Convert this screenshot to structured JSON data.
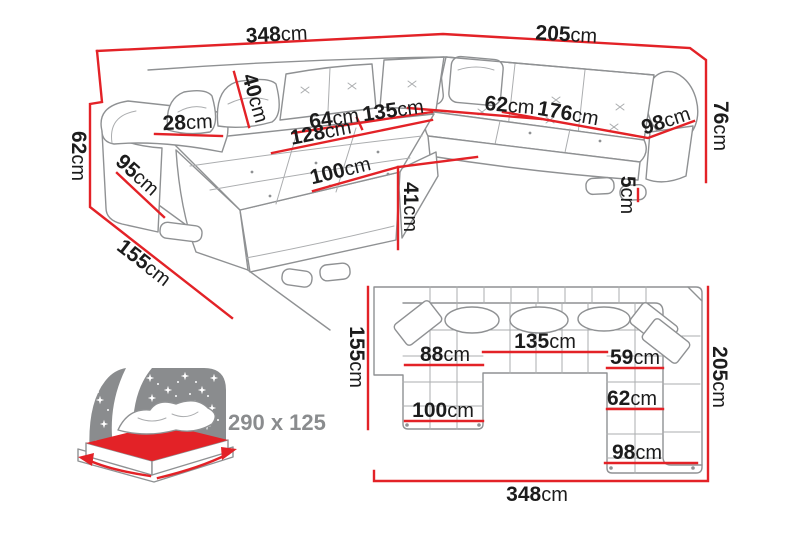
{
  "colors": {
    "red": "#e32227",
    "line_gray": "#8f9193",
    "text_dark": "#1c1c1c",
    "muted_gray": "#8a8c8e"
  },
  "perspective_view": {
    "labels": {
      "total_width": {
        "value": "348",
        "unit": "cm"
      },
      "right_section_width": {
        "value": "205",
        "unit": "cm"
      },
      "backrest_height": {
        "value": "76",
        "unit": "cm"
      },
      "cushion_height": {
        "value": "40",
        "unit": "cm"
      },
      "seat_depth_left": {
        "value": "64",
        "unit": "cm"
      },
      "middle_seat_width": {
        "value": "135",
        "unit": "cm"
      },
      "corner_seat_depth": {
        "value": "62",
        "unit": "cm"
      },
      "right_seat_length": {
        "value": "176",
        "unit": "cm"
      },
      "right_section_depth": {
        "value": "98",
        "unit": "cm"
      },
      "armrest_width": {
        "value": "28",
        "unit": "cm"
      },
      "chaise_length": {
        "value": "128",
        "unit": "cm"
      },
      "armrest_height": {
        "value": "62",
        "unit": "cm"
      },
      "side_depth": {
        "value": "95",
        "unit": "cm"
      },
      "chaise_width": {
        "value": "100",
        "unit": "cm"
      },
      "seat_height": {
        "value": "41",
        "unit": "cm"
      },
      "leg_height": {
        "value": "5",
        "unit": "cm"
      },
      "total_depth": {
        "value": "155",
        "unit": "cm"
      }
    }
  },
  "sleeping_function": {
    "bed_size": "290 x 125"
  },
  "top_view": {
    "labels": {
      "left_depth": {
        "value": "155",
        "unit": "cm"
      },
      "left_seat_width": {
        "value": "88",
        "unit": "cm"
      },
      "middle_seat_width": {
        "value": "135",
        "unit": "cm"
      },
      "right_seat_width": {
        "value": "59",
        "unit": "cm"
      },
      "right_depth": {
        "value": "205",
        "unit": "cm"
      },
      "chaise_width": {
        "value": "100",
        "unit": "cm"
      },
      "right_inner_width": {
        "value": "62",
        "unit": "cm"
      },
      "right_section_width": {
        "value": "98",
        "unit": "cm"
      },
      "total_width": {
        "value": "348",
        "unit": "cm"
      }
    }
  }
}
